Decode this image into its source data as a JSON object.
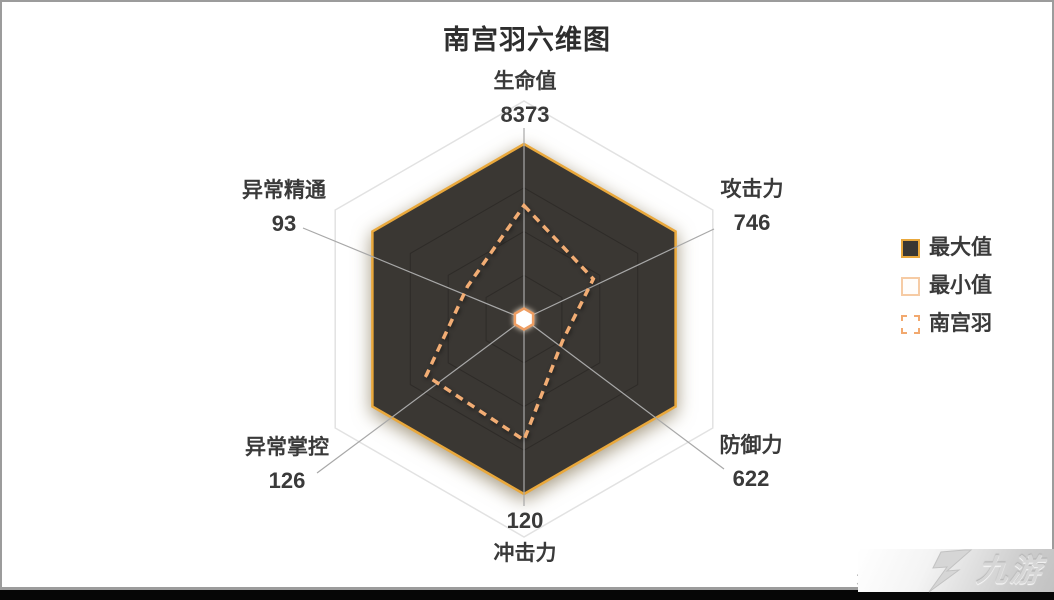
{
  "title": "南宫羽六维图",
  "chart_data": {
    "type": "radar",
    "title": "南宫羽六维图",
    "axes": [
      {
        "name": "生命值",
        "value": 8373,
        "position": "top"
      },
      {
        "name": "攻击力",
        "value": 746,
        "position": "upper-right"
      },
      {
        "name": "防御力",
        "value": 622,
        "position": "lower-right"
      },
      {
        "name": "冲击力",
        "value": 120,
        "position": "bottom"
      },
      {
        "name": "异常掌控",
        "value": 126,
        "position": "lower-left"
      },
      {
        "name": "异常精通",
        "value": 93,
        "position": "upper-left"
      }
    ],
    "series": [
      {
        "name": "最大值",
        "style": "filled-dark-hexagon",
        "ratio_of_axis": [
          1,
          1,
          1,
          1,
          1,
          1
        ]
      },
      {
        "name": "最小值",
        "style": "small-white-hexagon-at-center",
        "ratio_of_axis": [
          0.05,
          0.05,
          0.05,
          0.05,
          0.05,
          0.05
        ]
      },
      {
        "name": "南宫羽",
        "style": "dashed-outline",
        "ratio_of_axis": [
          0.65,
          0.46,
          0.25,
          0.69,
          0.65,
          0.37
        ]
      }
    ],
    "legend_position": "right",
    "grid": "hexagonal rings at 25%, 50%, 75%, 100%"
  },
  "legend": {
    "items": [
      {
        "label": "最大值"
      },
      {
        "label": "最小值"
      },
      {
        "label": "南宫羽"
      }
    ]
  },
  "watermark": {
    "partial_text": "米",
    "logo_text": "九游"
  },
  "colors": {
    "max_fill": "#3a3733",
    "max_border": "#e9a83c",
    "character_dashed": "#f2ad74",
    "min_border": "#ee9e63",
    "spoke_gray": "#a8a8a8",
    "outer_hex": "#e2e2e2",
    "text": "#3a3a3a"
  }
}
